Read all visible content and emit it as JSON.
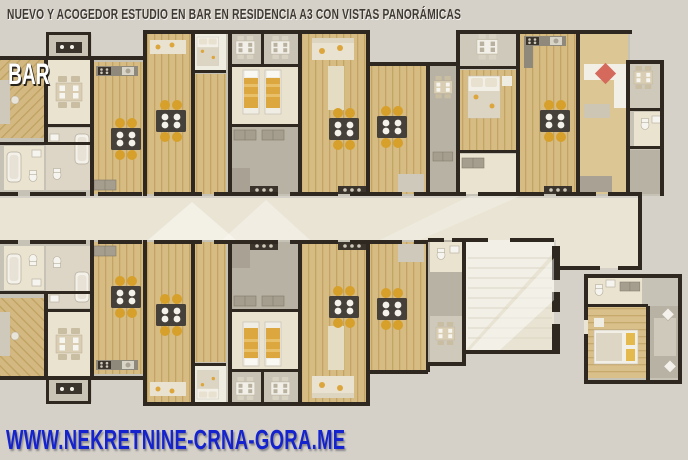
{
  "header": {
    "title": "NUEVO Y ACOGEDOR ESTUDIO EN BAR EN RESIDENCIA A3 CON VISTAS PANORÁMICAS"
  },
  "plan_overlay": {
    "location_label": "BAR"
  },
  "footer": {
    "website": "WWW.NEKRETNINE-CRNA-GORA.ME"
  },
  "palette": {
    "canvas": "#d5d1c8",
    "wall": "#2e2821",
    "wood": "#d5ba81",
    "cream": "#eae3d0",
    "corridor": "#e9e4d4",
    "accent_orange": "#d7a02a",
    "accent_red": "#d4695c",
    "url_blue": "#1523cf",
    "title_text": "#3f3a33"
  }
}
